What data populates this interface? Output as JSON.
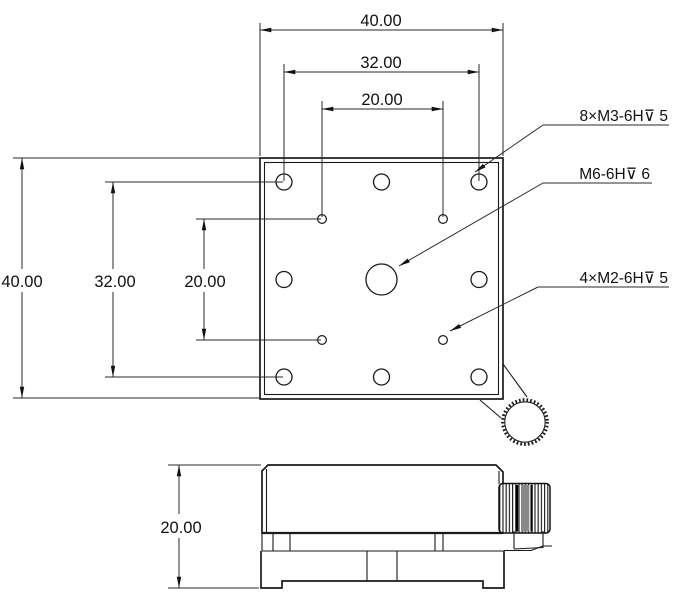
{
  "drawing": {
    "top_dims": {
      "outer": "40.00",
      "mid": "32.00",
      "inner": "20.00"
    },
    "left_dims": {
      "outer": "40.00",
      "mid": "32.00",
      "inner": "20.00"
    },
    "side_dims": {
      "height": "20.00"
    },
    "callouts": {
      "m3": "8×M3-6H⊽ 5",
      "m6": "M6-6H⊽ 6",
      "m2": "4×M2-6H⊽ 5"
    },
    "line_color": "#1a1a1a",
    "background": "#ffffff"
  }
}
